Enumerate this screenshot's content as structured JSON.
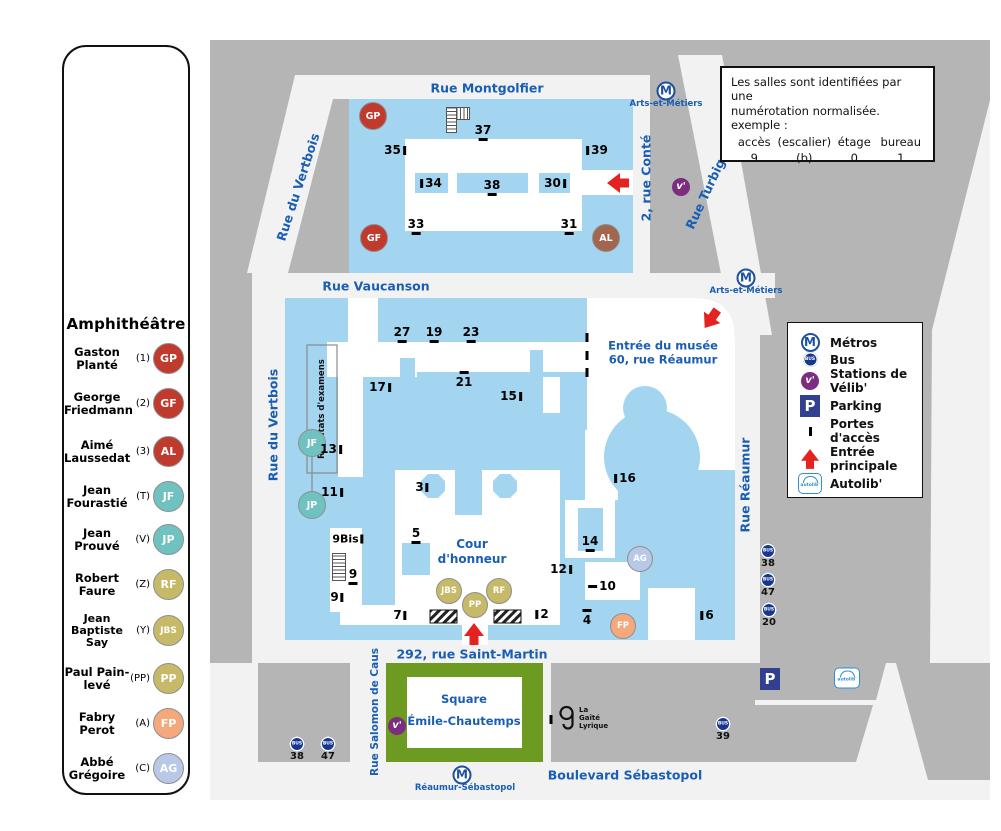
{
  "sidebar": {
    "title": "Amphithéâtre",
    "items": [
      {
        "name": "Gaston\nPlanté",
        "code": "(1)",
        "abbr": "GP",
        "color": "#c03a2e"
      },
      {
        "name": "George\nFriedmann",
        "code": "(2)",
        "abbr": "GF",
        "color": "#c03a2e"
      },
      {
        "name": "Aimé\nLaussedat",
        "code": "(3)",
        "abbr": "AL",
        "color": "#c03a2e"
      },
      {
        "name": "Jean\nFourastié",
        "code": "(T)",
        "abbr": "JF",
        "color": "#6fc2bf"
      },
      {
        "name": "Jean\nProuvé",
        "code": "(V)",
        "abbr": "JP",
        "color": "#6fc2bf"
      },
      {
        "name": "Robert\nFaure",
        "code": "(Z)",
        "abbr": "RF",
        "color": "#c6ba68"
      },
      {
        "name": "Jean\nBaptiste\nSay",
        "code": "(Y)",
        "abbr": "JBS",
        "color": "#c6ba68"
      },
      {
        "name": "Paul Pain-\nlevé",
        "code": "(PP)",
        "abbr": "PP",
        "color": "#c6ba68"
      },
      {
        "name": "Fabry\nPerot",
        "code": "(A)",
        "abbr": "FP",
        "color": "#f4a87c"
      },
      {
        "name": "Abbé\nGrégoire",
        "code": "(C)",
        "abbr": "AG",
        "color": "#b7c9e6"
      }
    ]
  },
  "info_box": {
    "line1": "Les salles sont identifiées par une",
    "line2": "numérotation normalisée.",
    "line3": "exemple :",
    "columns": [
      {
        "header": "accès",
        "value": "9"
      },
      {
        "header": "(escalier)",
        "value": "(b)"
      },
      {
        "header": "étage",
        "value": "0"
      },
      {
        "header": "bureau",
        "value": "1"
      }
    ]
  },
  "legend": {
    "items": [
      {
        "icon": "metro-icon",
        "label": "Métros"
      },
      {
        "icon": "bus-icon",
        "label": "Bus"
      },
      {
        "icon": "velib-icon",
        "label": "Stations de Vélib'"
      },
      {
        "icon": "parking-icon",
        "label": "Parking"
      },
      {
        "icon": "door-icon",
        "label": "Portes d'accès"
      },
      {
        "icon": "entrance-arrow-icon",
        "label": "Entrée principale"
      },
      {
        "icon": "autolib-icon",
        "label": "Autolib'"
      }
    ]
  },
  "streets": {
    "montgolfier": "Rue Montgolfier",
    "vertbois_top": "Rue du Vertbois",
    "vertbois_main": "Rue du Vertbois",
    "vaucanson": "Rue Vaucanson",
    "conte": "2, rue Conté",
    "turbigo": "Rue Turbigo",
    "reaumur": "Rue Réaumur",
    "saint_martin": "292, rue Saint-Martin",
    "salomon": "Rue Salomon de Caus",
    "sebastopol": "Boulevard Sébastopol"
  },
  "metro": {
    "symbol": "M",
    "station_top": "Arts-et-Métiers",
    "station_mid": "Arts-et-Métiers",
    "station_bottom": "Réaumur-Sébastopol"
  },
  "bus": {
    "symbol": "BUS",
    "stops_right": [
      "38",
      "47",
      "20"
    ],
    "stops_bottom_left": [
      "38",
      "47"
    ],
    "stop_gaite": "39"
  },
  "velib": {
    "symbol": "v'"
  },
  "parking": {
    "symbol": "P"
  },
  "autolib": {
    "label": "autolib'"
  },
  "map_labels": {
    "cour": "Cour\nd'honneur",
    "musee": "Entrée du musée\n60, rue Réaumur",
    "square": "Square\nÉmile-Chautemps",
    "resultats": "Résultats d'examens",
    "gaite": "La\nGaîté\nLyrique"
  },
  "top_block": {
    "doors": [
      "35",
      "37",
      "39",
      "33",
      "31"
    ],
    "rooms": [
      "34",
      "38",
      "30"
    ],
    "amphis": [
      "GP",
      "GF",
      "AL"
    ]
  },
  "main_block": {
    "doors": [
      "27",
      "19",
      "23",
      "17",
      "21",
      "15",
      "13",
      "11",
      "3",
      "5",
      "9Bis",
      "9",
      "9",
      "7",
      "2",
      "4",
      "10",
      "12",
      "14",
      "16",
      "6"
    ],
    "amphis": [
      "JF",
      "JP",
      "JBS",
      "PP",
      "RF",
      "FP",
      "AG"
    ]
  },
  "colors": {
    "campus_blue": "#a3d4f0",
    "block_gray": "#b5b5b5",
    "square_green": "#6d9b21",
    "street_label_blue": "#1a5eb4",
    "metro_blue": "#1d4fa0",
    "bus_blue": "#17378f",
    "velib_purple": "#7c2d7f",
    "parking_blue": "#333f8f",
    "entrance_red": "#e42320",
    "amphi_red": "#c03a2e",
    "amphi_teal": "#6fc2bf",
    "amphi_khaki": "#c6ba68",
    "amphi_orange": "#f4a87c",
    "amphi_lightblue": "#b7c9e6"
  }
}
